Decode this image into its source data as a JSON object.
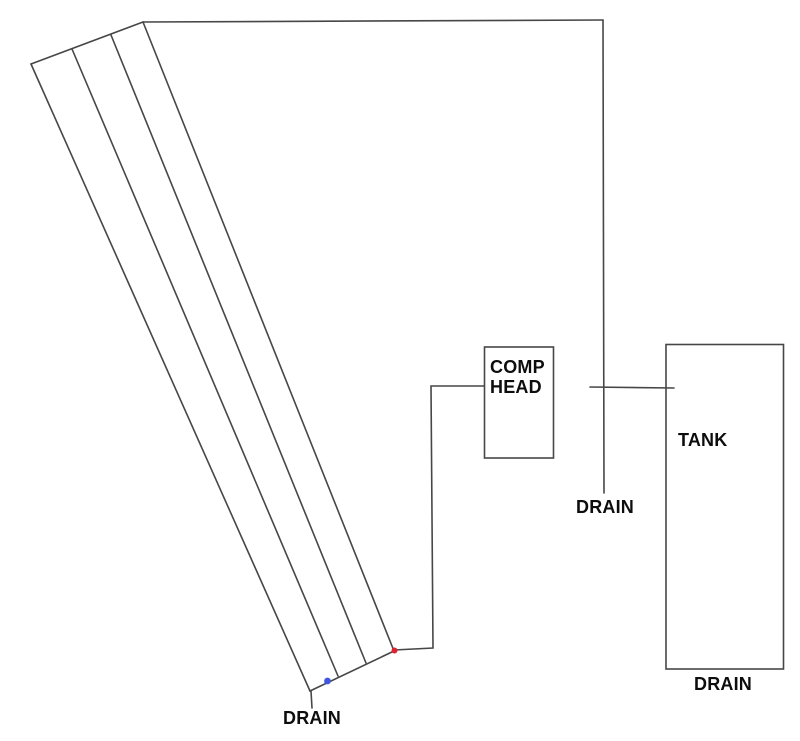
{
  "canvas": {
    "width": 800,
    "height": 741,
    "background": "#ffffff"
  },
  "colors": {
    "line": "#474747",
    "text": "#0d0d0d",
    "red_marker": "#de2230",
    "blue_marker": "#4156de"
  },
  "boxes": {
    "comp_head": {
      "label_line1": "COMP",
      "label_line2": "HEAD"
    },
    "tank": {
      "label": "TANK"
    }
  },
  "drains": {
    "pipe_drain_label": "DRAIN",
    "line_drain_label": "DRAIN",
    "tank_drain_label": "DRAIN"
  },
  "markers": {
    "red_dot": "red-drain-point",
    "blue_dot": "blue-drain-point"
  }
}
